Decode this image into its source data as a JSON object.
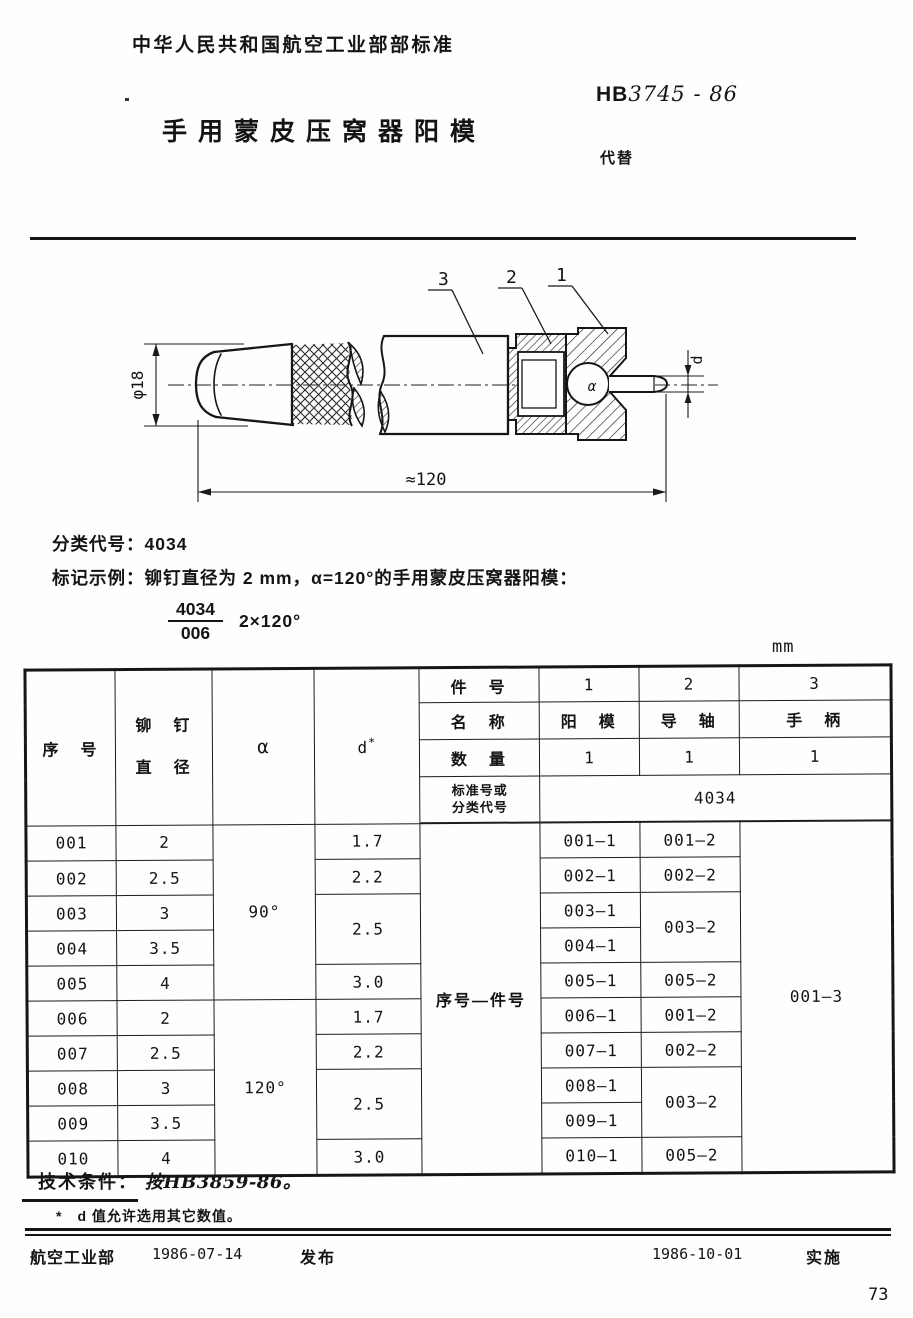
{
  "header": {
    "org_line": "中华人民共和国航空工业部部标准",
    "standard_prefix": "HB",
    "standard_number": "3745 - 86",
    "title": "手用蒙皮压窝器阳模",
    "replaces_label": "代替"
  },
  "drawing": {
    "callout_1": "1",
    "callout_2": "2",
    "callout_3": "3",
    "dim_diameter": "φ18",
    "dim_length": "≈120",
    "dim_tip_diameter": "d",
    "angle_label": "α"
  },
  "classification": {
    "code_line": "分类代号：4034",
    "example_label": "标记示例：铆钉直径为 2 mm，α=120°的手用蒙皮压窝器阳模：",
    "fraction_top": "4034",
    "fraction_bottom": "006",
    "fraction_suffix": "2×120°"
  },
  "table": {
    "unit": "mm",
    "headers": {
      "seq": "序　号",
      "rivet_line1": "铆　钉",
      "rivet_line2": "直　径",
      "alpha": "α",
      "d_base": "d",
      "d_star": "*",
      "item_no": "件　号",
      "name": "名　称",
      "qty": "数　量",
      "std_line1": "标准号或",
      "std_line2": "分类代号"
    },
    "item_nos": [
      "1",
      "2",
      "3"
    ],
    "names": [
      "阳　模",
      "导　轴",
      "手　柄"
    ],
    "qtys": [
      "1",
      "1",
      "1"
    ],
    "std_value": "4034",
    "span_label": "序号—件号",
    "handle_part": "001—3",
    "alpha_cells": [
      "90°",
      "120°"
    ],
    "d_cells": [
      "1.7",
      "2.2",
      "2.5",
      "3.0",
      "1.7",
      "2.2",
      "2.5",
      "3.0"
    ],
    "p2_cells": [
      "001—2",
      "002—2",
      "003—2",
      "005—2",
      "001—2",
      "002—2",
      "003—2",
      "005—2"
    ],
    "rows": [
      {
        "seq": "001",
        "dia": "2",
        "p1": "001—1"
      },
      {
        "seq": "002",
        "dia": "2.5",
        "p1": "002—1"
      },
      {
        "seq": "003",
        "dia": "3",
        "p1": "003—1"
      },
      {
        "seq": "004",
        "dia": "3.5",
        "p1": "004—1"
      },
      {
        "seq": "005",
        "dia": "4",
        "p1": "005—1"
      },
      {
        "seq": "006",
        "dia": "2",
        "p1": "006—1"
      },
      {
        "seq": "007",
        "dia": "2.5",
        "p1": "007—1"
      },
      {
        "seq": "008",
        "dia": "3",
        "p1": "008—1"
      },
      {
        "seq": "009",
        "dia": "3.5",
        "p1": "009—1"
      },
      {
        "seq": "010",
        "dia": "4",
        "p1": "010—1"
      }
    ]
  },
  "notes": {
    "tech_label": "技术条件：",
    "tech_value": "按HB3859-86。",
    "footnote": "*　d 值允许选用其它数值。"
  },
  "footer": {
    "issuer": "航空工业部",
    "issue_date": "1986-07-14",
    "publish_label": "发布",
    "impl_date": "1986-10-01",
    "impl_label": "实施",
    "page_number": "73"
  }
}
